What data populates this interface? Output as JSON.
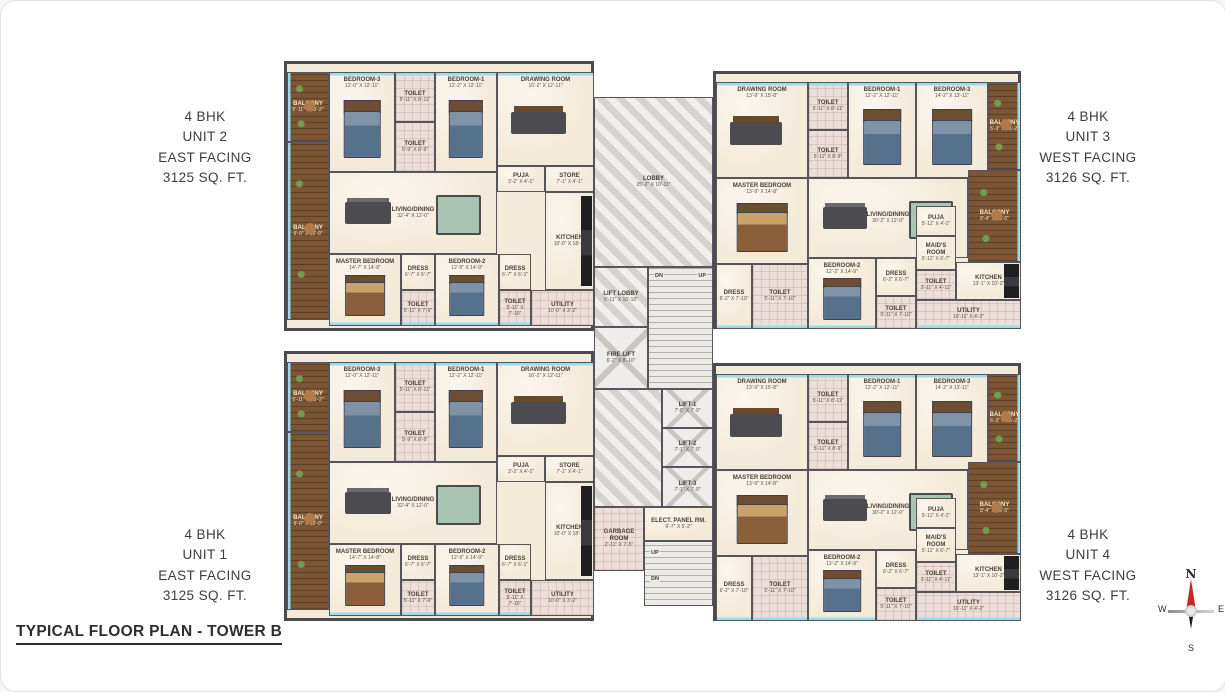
{
  "title": "TYPICAL FLOOR PLAN - TOWER B",
  "colors": {
    "wall": "#54535a",
    "floor": "#f2e7d6",
    "balcony_wood": "#7b5433",
    "wet_tile": "#e9dbd5",
    "core_marble": "#dedbd8",
    "window": "#9adbec",
    "compass_needle_red": "#c42b1f",
    "text": "#3d3d3d"
  },
  "units": {
    "unit2": {
      "bhk": "4 BHK",
      "unit": "UNIT 2",
      "facing": "EAST FACING",
      "area": "3125 SQ. FT."
    },
    "unit3": {
      "bhk": "4 BHK",
      "unit": "UNIT 3",
      "facing": "WEST FACING",
      "area": "3126 SQ. FT."
    },
    "unit1": {
      "bhk": "4 BHK",
      "unit": "UNIT 1",
      "facing": "EAST FACING",
      "area": "3125 SQ. FT."
    },
    "unit4": {
      "bhk": "4 BHK",
      "unit": "UNIT 4",
      "facing": "WEST FACING",
      "area": "3126 SQ. FT."
    }
  },
  "east": {
    "balcony1": {
      "name": "BALCONY",
      "dims": "5'-11\" X 15'-2\""
    },
    "balcony2": {
      "name": "BALCONY",
      "dims": "6'-0\" X 12'-0\""
    },
    "bedroom3": {
      "name": "BEDROOM-3",
      "dims": "12'-0\" X 12'-11\""
    },
    "toilet1": {
      "name": "TOILET",
      "dims": "5'-11\" X 8'-11\""
    },
    "toilet2": {
      "name": "TOILET",
      "dims": "5'-9\" X 8'-9\""
    },
    "bedroom1": {
      "name": "BEDROOM-1",
      "dims": "12'-2\" X 12'-11\""
    },
    "drawing": {
      "name": "DRAWING ROOM",
      "dims": "16'-2\" X 12'-11\""
    },
    "puja": {
      "name": "PUJA",
      "dims": "3'-2\" X 4'-1\""
    },
    "store": {
      "name": "STORE",
      "dims": "7'-1\" X 4'-1\""
    },
    "living": {
      "name": "LIVING/DINING",
      "dims": "32'-4\" X 12'-0\""
    },
    "kitchen": {
      "name": "KITCHEN",
      "dims": "10'-0\" X 18'-2\""
    },
    "master": {
      "name": "MASTER BEDROOM",
      "dims": "14'-7\" X 14'-8\""
    },
    "dress1": {
      "name": "DRESS",
      "dims": "6'-7\" X 6'-7\""
    },
    "toilet3": {
      "name": "TOILET",
      "dims": "5'-11\" X 7'-9\""
    },
    "bedroom2": {
      "name": "BEDROOM-2",
      "dims": "12'-9\" X 14'-9\""
    },
    "dress2": {
      "name": "DRESS",
      "dims": "6'-7\" X 6'-1\""
    },
    "toilet4": {
      "name": "TOILET",
      "dims": "5'-11\" X 7'-10\""
    },
    "utility": {
      "name": "UTILITY",
      "dims": "10'-0\" X 3'-2\""
    }
  },
  "west": {
    "drawing": {
      "name": "DRAWING ROOM",
      "dims": "13'-9\" X 15'-8\""
    },
    "toilet1": {
      "name": "TOILET",
      "dims": "5'-11\" X 8'-11\""
    },
    "toilet2": {
      "name": "TOILET",
      "dims": "5'-11\" X 8'-9\""
    },
    "bedroom1": {
      "name": "BEDROOM-1",
      "dims": "12'-2\" X 12'-11\""
    },
    "bedroom3": {
      "name": "BEDROOM-3",
      "dims": "14'-2\" X 13'-11\""
    },
    "balcony1": {
      "name": "BALCONY",
      "dims": "5'-3\" X 15'-2\""
    },
    "master": {
      "name": "MASTER BEDROOM",
      "dims": "13'-9\" X 14'-8\""
    },
    "living": {
      "name": "LIVING/DINING",
      "dims": "30'-2\" X 12'-0\""
    },
    "balcony2": {
      "name": "BALCONY",
      "dims": "8'-4\" X 13'-0\""
    },
    "dress1": {
      "name": "DRESS",
      "dims": "6'-2\" X 7'-10\""
    },
    "toilet3": {
      "name": "TOILET",
      "dims": "5'-11\" X 7'-10\""
    },
    "bedroom2": {
      "name": "BEDROOM-2",
      "dims": "12'-2\" X 14'-9\""
    },
    "dress2": {
      "name": "DRESS",
      "dims": "6'-2\" X 6'-7\""
    },
    "toilet4": {
      "name": "TOILET",
      "dims": "5'-11\" X 7'-10\""
    },
    "puja": {
      "name": "PUJA",
      "dims": "5'-11\" X 4'-1\""
    },
    "maids": {
      "name": "MAID'S ROOM",
      "dims": "5'-11\" X 6'-7\""
    },
    "toilet5": {
      "name": "TOILET",
      "dims": "3'-11\" X 4'-11\""
    },
    "kitchen": {
      "name": "KITCHEN",
      "dims": "13'-1\" X 10'-2\""
    },
    "utility": {
      "name": "UTILITY",
      "dims": "10'-11\" X 4'-2\""
    }
  },
  "core": {
    "lobby": {
      "name": "LOBBY",
      "dims": "25'-2\" X 10'-11\""
    },
    "lift_lobby": {
      "name": "LIFT LOBBY",
      "dims": "6'-11\" X 10'-10\""
    },
    "fire_lift": {
      "name": "FIRE LIFT",
      "dims": "6'-2\" X 8'-10\""
    },
    "lift1": {
      "name": "LIFT-1",
      "dims": "7'-8\" X 7'-0\""
    },
    "lift2": {
      "name": "LIFT-2",
      "dims": "7'-1\" X 7'-0\""
    },
    "lift3": {
      "name": "LIFT-3",
      "dims": "7'-1\" X 7'-0\""
    },
    "elect": {
      "name": "ELECT. PANEL RM.",
      "dims": "6'-7\" X 5'-2\""
    },
    "garbage": {
      "name": "GARBAGE ROOM",
      "dims": "2'-11\" X 7'-5\""
    },
    "up": "UP",
    "dn": "DN"
  },
  "compass": {
    "n": "N",
    "e": "E",
    "s": "S",
    "w": "W"
  }
}
